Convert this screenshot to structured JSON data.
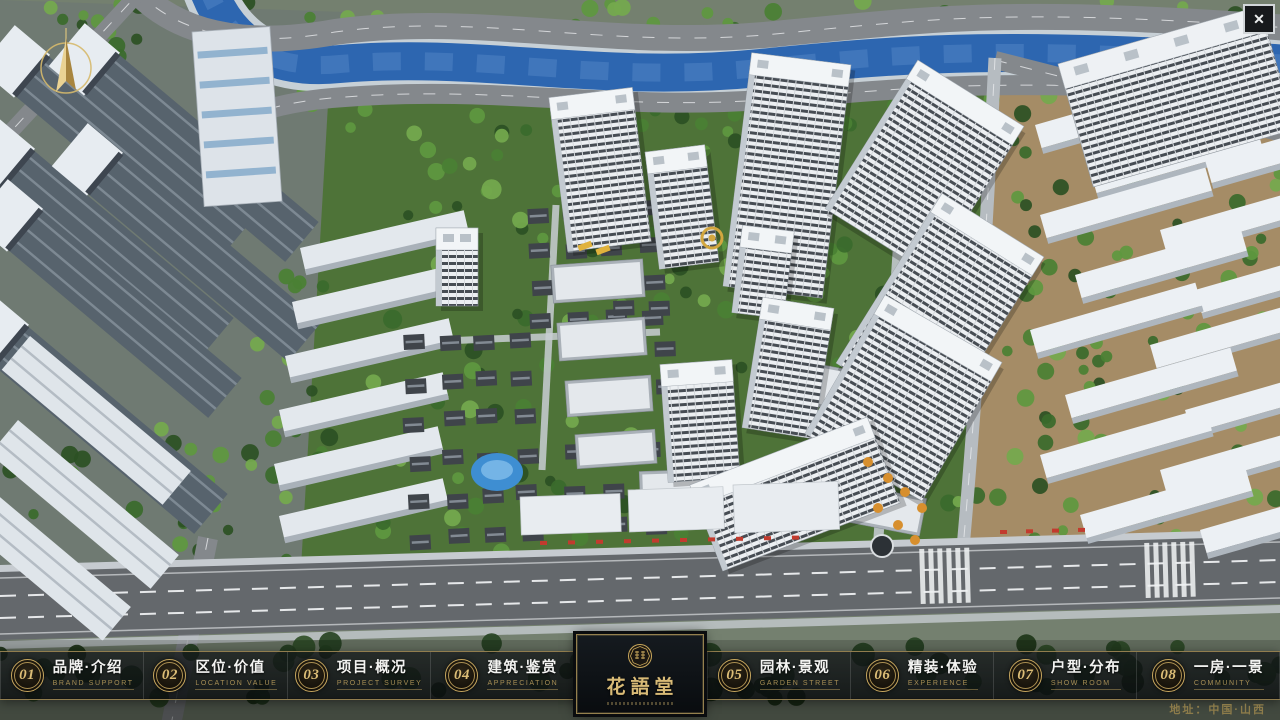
{
  "window": {
    "close": "✕"
  },
  "nav": {
    "items": [
      {
        "num": "01",
        "zh": "品牌·介绍",
        "en": "BRAND SUPPORT"
      },
      {
        "num": "02",
        "zh": "区位·价值",
        "en": "LOCATION VALUE"
      },
      {
        "num": "03",
        "zh": "项目·概况",
        "en": "PROJECT SURVEY"
      },
      {
        "num": "04",
        "zh": "建筑·鉴赏",
        "en": "APPRECIATION"
      },
      {
        "num": "05",
        "zh": "园林·景观",
        "en": "GARDEN STREET"
      },
      {
        "num": "06",
        "zh": "精装·体验",
        "en": "EXPERIENCE"
      },
      {
        "num": "07",
        "zh": "户型·分布",
        "en": "SHOW ROOM"
      },
      {
        "num": "08",
        "zh": "一房·一景",
        "en": "COMMUNITY"
      }
    ]
  },
  "logo": {
    "title": "花語堂"
  },
  "footer": {
    "address": "地址：中国·山西"
  },
  "colors": {
    "gold": "#c9a85c",
    "water": "#2d66b0",
    "bar_bg": "rgba(12,15,17,0.78)"
  }
}
